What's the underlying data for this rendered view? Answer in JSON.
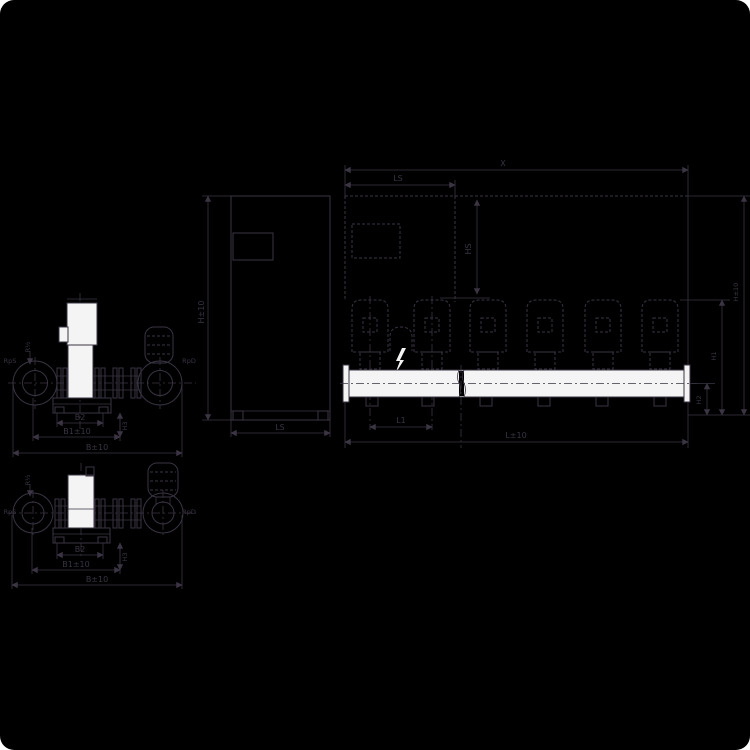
{
  "canvas": {
    "background": "#000000",
    "line_color": "#3a3443",
    "fill_color": "#f4f4f4",
    "corner_color": "#ffffff"
  },
  "front_view_a": {
    "labels": {
      "rps": "RpS",
      "rpd": "RpD",
      "vent": "R½",
      "b2": "B2",
      "b1": "B1±10",
      "b": "B±10",
      "h3": "H3"
    }
  },
  "front_view_b": {
    "labels": {
      "rps": "RpS",
      "rpd": "RpD",
      "vent": "R½",
      "b2": "B2",
      "b1": "B1±10",
      "b": "B±10",
      "h3": "H3"
    }
  },
  "side_view": {
    "labels": {
      "h": "H±10",
      "ls": "LS"
    }
  },
  "main_view": {
    "labels": {
      "x": "X",
      "ls": "LS",
      "hs": "HS",
      "l1": "L1",
      "l": "L±10",
      "h1": "H1",
      "h2": "H2",
      "h": "H±10"
    }
  }
}
